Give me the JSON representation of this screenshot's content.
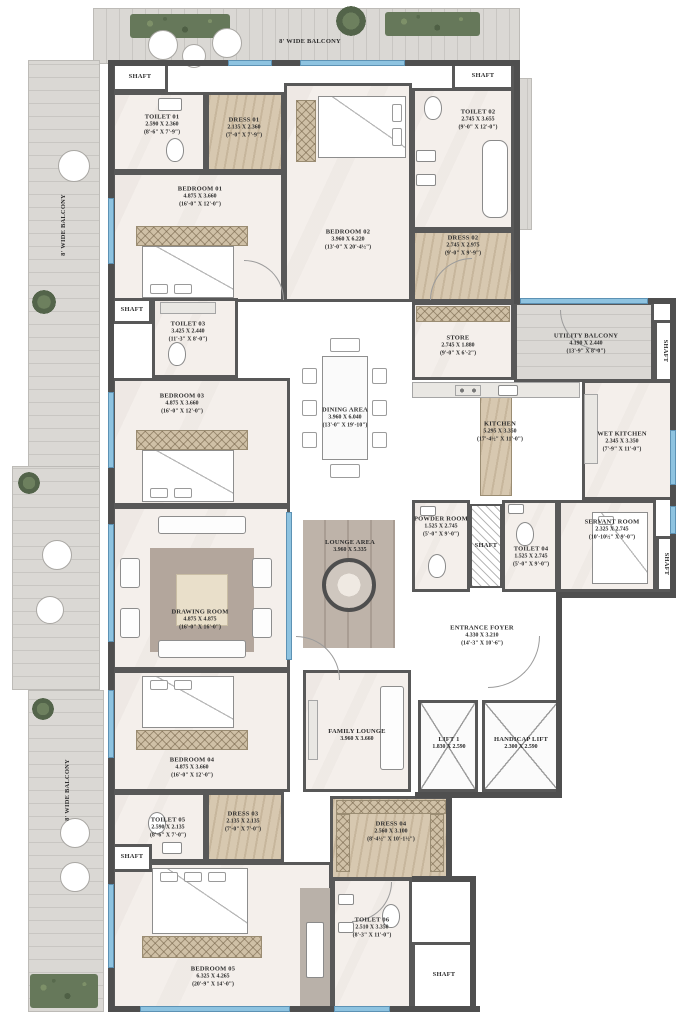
{
  "labels": {
    "balcony": "8' WIDE BALCONY",
    "shaft": "SHAFT"
  },
  "rooms": {
    "toilet01": {
      "name": "TOILET 01",
      "m": "2.590 X 2.360",
      "ft": "(8'-6\" X 7'-9\")"
    },
    "dress01": {
      "name": "DRESS 01",
      "m": "2.135 X 2.360",
      "ft": "(7'-0\" X 7'-9\")"
    },
    "bedroom01": {
      "name": "BEDROOM 01",
      "m": "4.875 X 3.660",
      "ft": "(16'-0\" X 12'-0\")"
    },
    "bedroom02": {
      "name": "BEDROOM 02",
      "m": "3.960 X 6.220",
      "ft": "(13'-0\" X 20'-4½\")"
    },
    "toilet02": {
      "name": "TOILET 02",
      "m": "2.745 X 3.655",
      "ft": "(9'-0\" X 12'-0\")"
    },
    "dress02": {
      "name": "DRESS 02",
      "m": "2.745 X 2.975",
      "ft": "(9'-0\" X 9'-9\")"
    },
    "toilet03": {
      "name": "TOILET 03",
      "m": "3.425 X 2.440",
      "ft": "(11'-3\" X 8'-0\")"
    },
    "bedroom03": {
      "name": "BEDROOM 03",
      "m": "4.875 X 3.660",
      "ft": "(16'-0\" X 12'-0\")"
    },
    "dining": {
      "name": "DINING AREA",
      "m": "3.960 X 6.040",
      "ft": "(13'-0\" X 19'-10\")"
    },
    "store": {
      "name": "STORE",
      "m": "2.745 X 1.880",
      "ft": "(9'-0\" X 6'-2\")"
    },
    "utility": {
      "name": "UTILITY BALCONY",
      "m": "4.190 X 2.440",
      "ft": "(13'-9\" X 8'-0\")"
    },
    "kitchen": {
      "name": "KITCHEN",
      "m": "5.295 X 3.350",
      "ft": "(17'-4½\" X 11'-0\")"
    },
    "wetkitchen": {
      "name": "WET KITCHEN",
      "m": "2.345 X 3.350",
      "ft": "(7'-9\" X 11'-0\")"
    },
    "drawing": {
      "name": "DRAWING ROOM",
      "m": "4.875 X 4.875",
      "ft": "(16'-0\" X 16'-0\")"
    },
    "lounge": {
      "name": "LOUNGE AREA",
      "m": "3.960 X 5.335",
      "ft": ""
    },
    "powder": {
      "name": "POWDER ROOM",
      "m": "1.525 X 2.745",
      "ft": "(5'-0\" X 9'-0\")"
    },
    "toilet04": {
      "name": "TOILET 04",
      "m": "1.525 X 2.745",
      "ft": "(5'-0\" X 9'-0\")"
    },
    "servant": {
      "name": "SERVANT ROOM",
      "m": "2.325 X 2.745",
      "ft": "(10'-10½\" X 9'-0\")"
    },
    "foyer": {
      "name": "ENTRANCE FOYER",
      "m": "4.330 X 3.210",
      "ft": "(14'-3\" X 10'-6\")"
    },
    "bedroom04": {
      "name": "BEDROOM 04",
      "m": "4.875 X 3.660",
      "ft": "(16'-0\" X 12'-0\")"
    },
    "family": {
      "name": "FAMILY LOUNGE",
      "m": "3.960 X 3.660",
      "ft": ""
    },
    "lift1": {
      "name": "LIFT 1",
      "m": "1.830 X 2.590",
      "ft": ""
    },
    "hlift": {
      "name": "HANDICAP LIFT",
      "m": "2.300 X 2.590",
      "ft": ""
    },
    "toilet05": {
      "name": "TOILET 05",
      "m": "2.590 X 2.135",
      "ft": "(8'-6\" X 7'-0\")"
    },
    "dress03": {
      "name": "DRESS 03",
      "m": "2.135 X 2.135",
      "ft": "(7'-0\" X 7'-0\")"
    },
    "dress04": {
      "name": "DRESS 04",
      "m": "2.560 X 3.100",
      "ft": "(8'-4½\" X 10'-1½\")"
    },
    "bedroom05": {
      "name": "BEDROOM 05",
      "m": "6.325 X 4.265",
      "ft": "(20'-9\" X 14'-0\")"
    },
    "toilet06": {
      "name": "TOILET 06",
      "m": "2.510 X 3.350",
      "ft": "(8'-3\" X 11'-0\")"
    }
  },
  "colors": {
    "wall": "#4f4f4f",
    "window": "#8ec3e0",
    "deck": "#d4d2ce",
    "wood": "#d7c8b0"
  }
}
